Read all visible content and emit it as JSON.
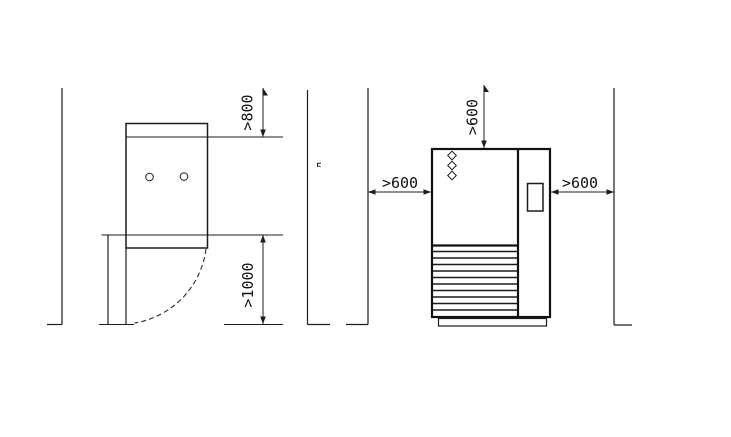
{
  "diagram": {
    "description_colors": {
      "line_color": "#1c1c1c",
      "background_color": "#ffffff"
    },
    "plan_view": {
      "rear_clearance_label": ">800",
      "front_clearance_label": ">1000"
    },
    "front_view": {
      "top_clearance_label": ">600",
      "left_clearance_label": ">600",
      "right_clearance_label": ">600"
    }
  }
}
